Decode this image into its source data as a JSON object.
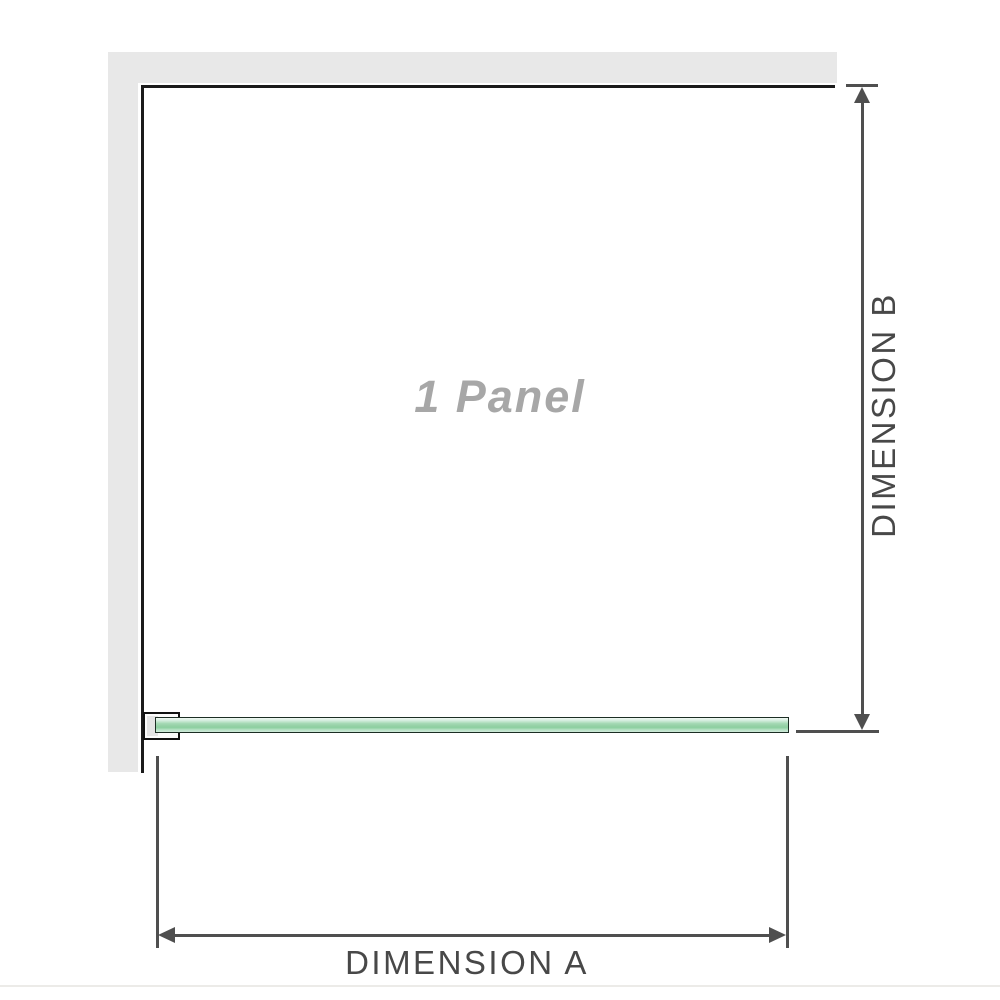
{
  "labels": {
    "panel": "1 Panel",
    "dimension_a": "DIMENSION A",
    "dimension_b": "DIMENSION B"
  },
  "colors": {
    "wall_fill": "#e8e8e8",
    "frame_line": "#1b1b1b",
    "dim_line": "#4f4f4f",
    "dim_text": "#484848",
    "panel_label": "#a7a7a7",
    "glass_outline": "#1c2e24",
    "glass_mid": "#96d1a7",
    "bracket_fill": "#e4e4e4",
    "baseline": "#ecebe8"
  }
}
